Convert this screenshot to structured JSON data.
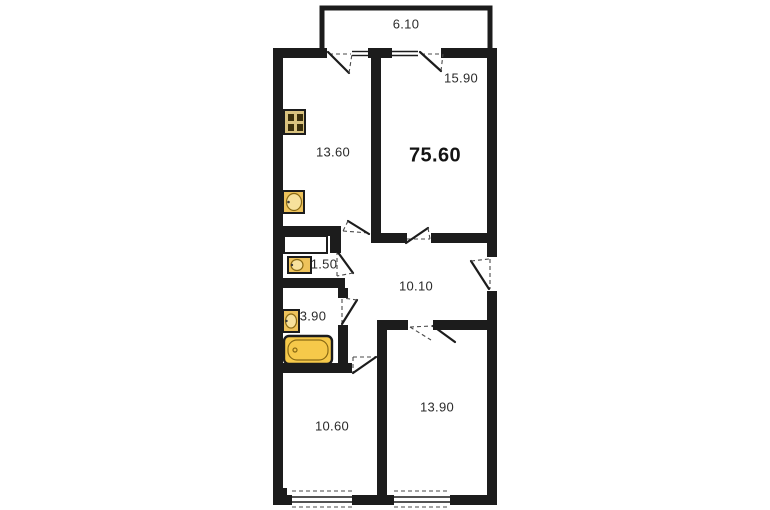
{
  "floor_plan": {
    "total_area_label": "75.60",
    "balcony": {
      "area": "6.10"
    },
    "living_room": {
      "area": "15.90"
    },
    "kitchen": {
      "area": "13.60"
    },
    "wc": {
      "area": "1.50"
    },
    "hallway": {
      "area": "10.10"
    },
    "bathroom": {
      "area": "3.90"
    },
    "bedroom_small": {
      "area": "10.60"
    },
    "bedroom_large": {
      "area": "13.90"
    },
    "icons": {
      "stove-icon": "4-burner stove",
      "kitchen-sink-icon": "kitchen sink",
      "wc-sink-icon": "small wash basin",
      "bathroom-sink-icon": "wash basin",
      "bathtub-icon": "bathtub"
    },
    "colors": {
      "wall": "#1c1c1c",
      "stove_fill": "#d9c27f",
      "stove_burner": "#3a2e0b",
      "fixture_fill": "#eec35b",
      "fixture_inner": "#f7e19c",
      "bathtub_fill": "#f6c94a",
      "label_text": "#2b2b2b"
    }
  }
}
